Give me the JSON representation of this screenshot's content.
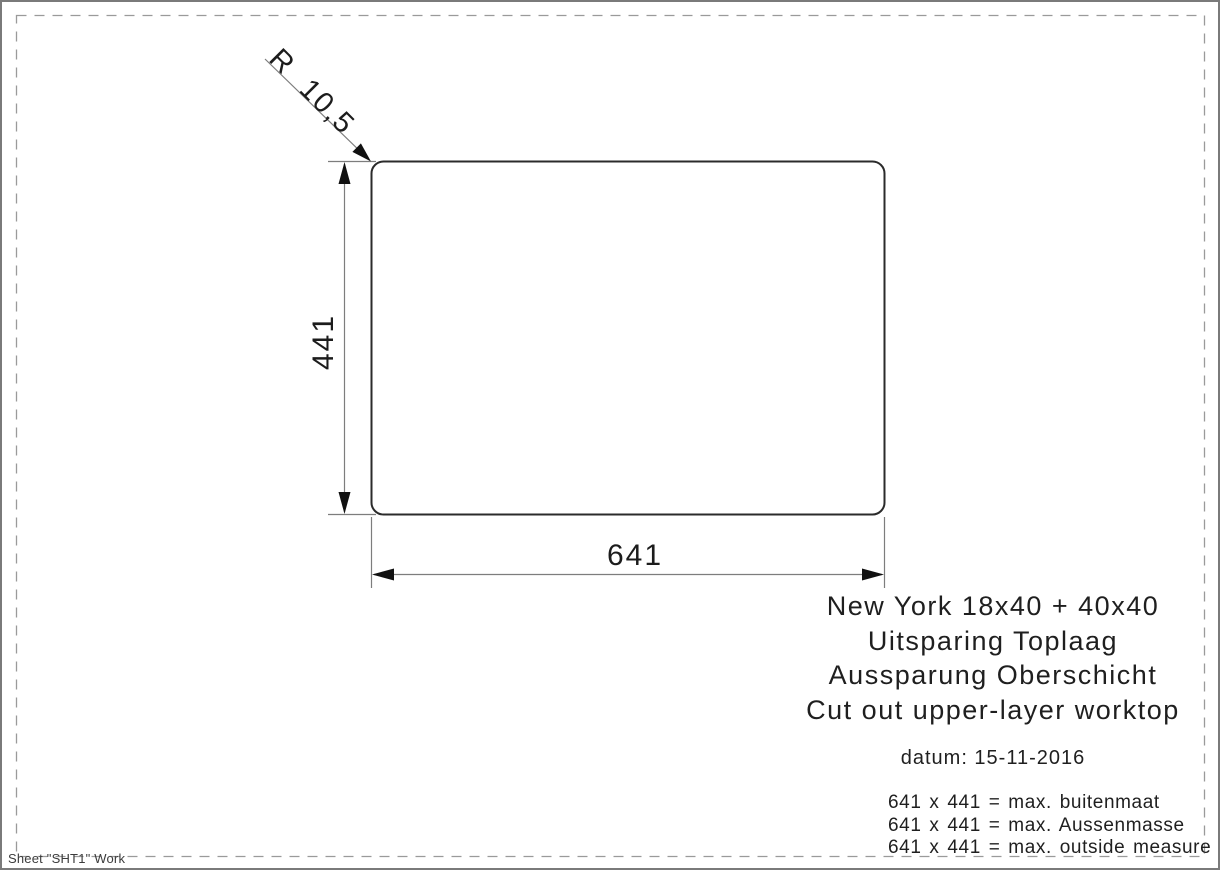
{
  "page": {
    "background": "#ffffff",
    "border_color": "#7a7a7a",
    "dashed_frame_color": "#9a9a9a"
  },
  "drawing": {
    "outline_color": "#2b2b2b",
    "dimension_line_color": "#7d7d7d",
    "width_dim": "641",
    "height_dim": "441",
    "radius_label": "R 10,5"
  },
  "title_block": {
    "lines": [
      "New York 18x40 + 40x40",
      "Uitsparing Toplaag",
      "Aussparung Oberschicht",
      "Cut out upper-layer worktop"
    ],
    "date_label": "datum: 15-11-2016",
    "measure_lines": [
      "641 x 441 = max. buitenmaat",
      "641 x 441 = max. Aussenmasse",
      "641 x 441 = max. outside measure"
    ]
  },
  "footer": {
    "sheet_label": "Sheet \"SHT1\" Work"
  }
}
